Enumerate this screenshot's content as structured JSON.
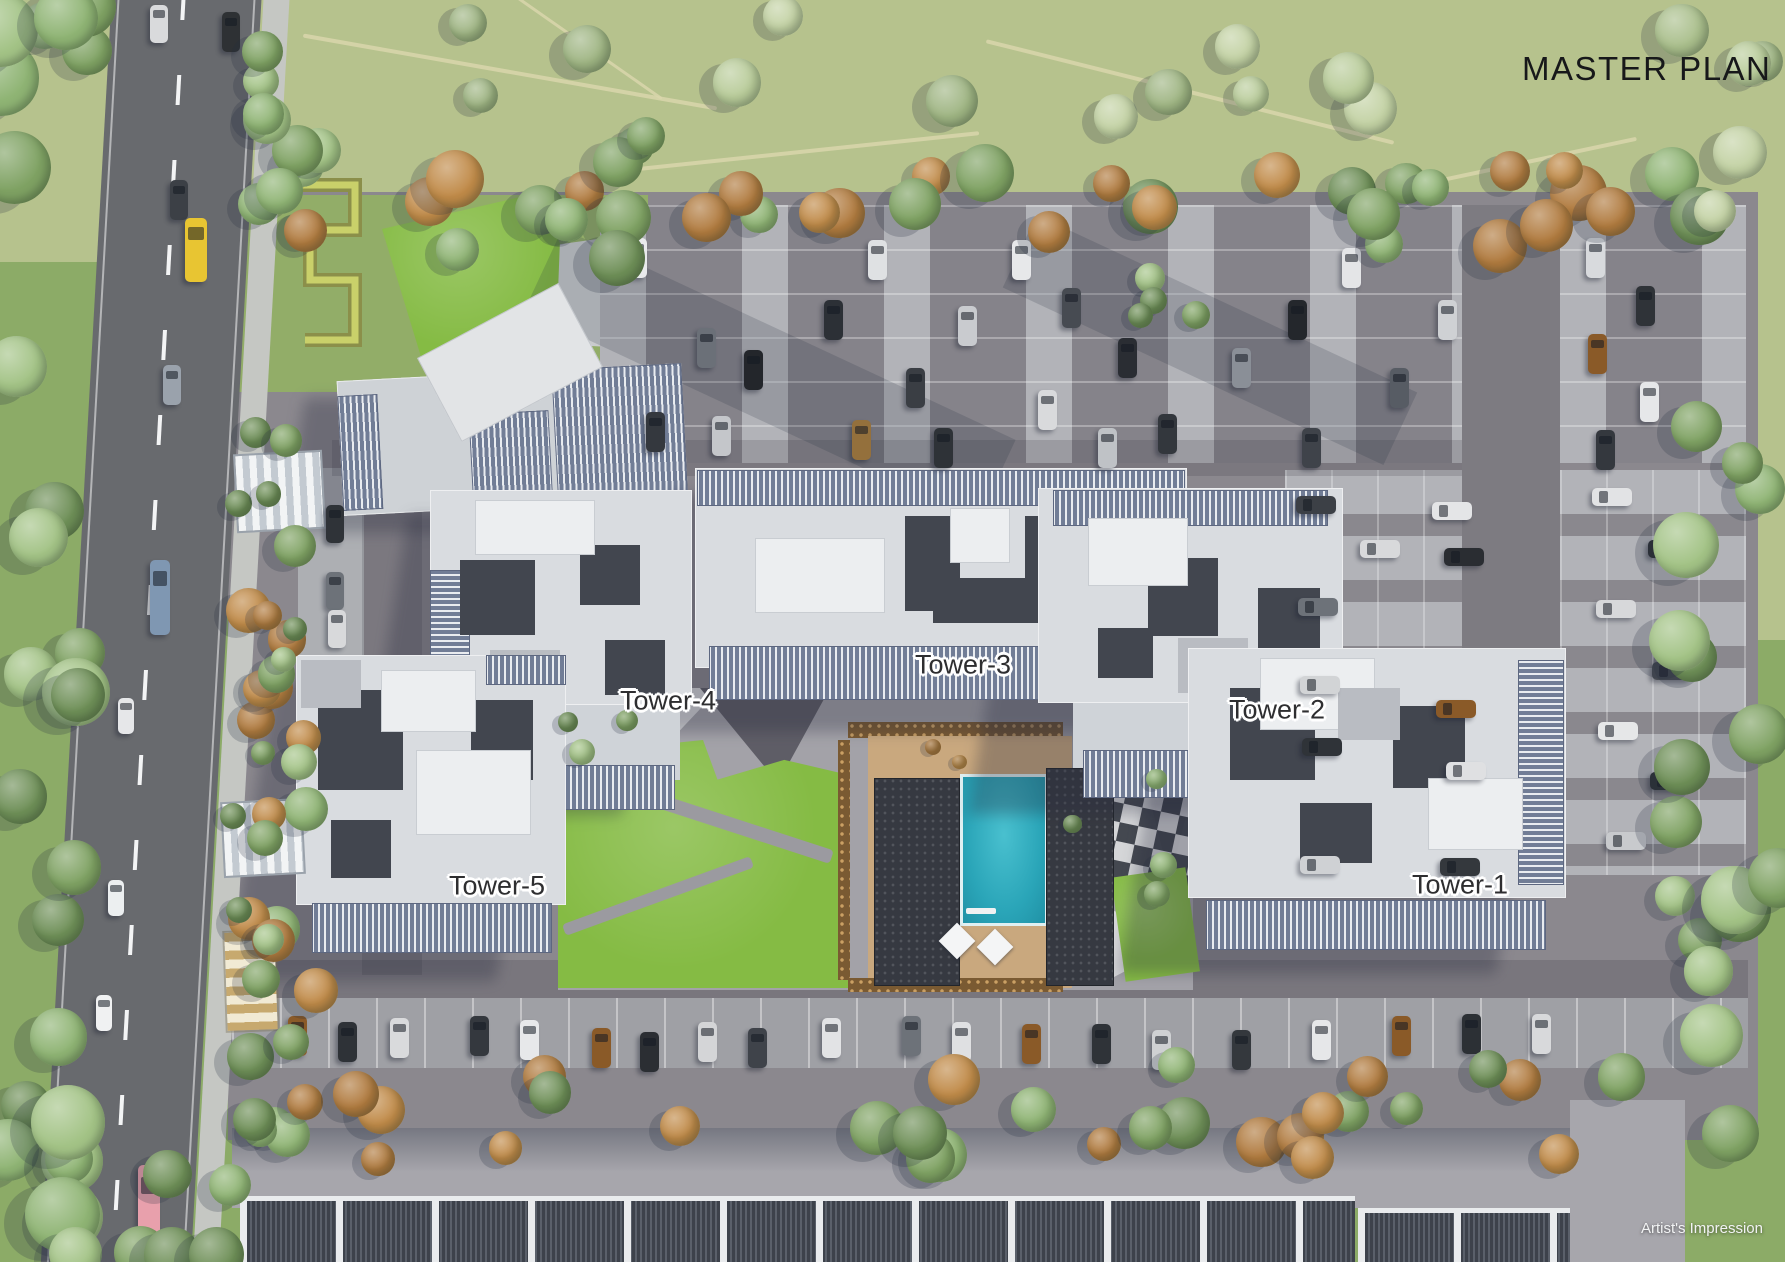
{
  "header": {
    "title": "MASTER PLAN"
  },
  "towers": [
    {
      "label": "Tower-1"
    },
    {
      "label": "Tower-2"
    },
    {
      "label": "Tower-3"
    },
    {
      "label": "Tower-4"
    },
    {
      "label": "Tower-5"
    }
  ],
  "footer": {
    "credit": "Artist's Impression"
  },
  "colors": {
    "pool": "#2aa5b8",
    "lawn": "#85bb44",
    "field": "#b6c28d",
    "road": "#686a6e",
    "tower_roof": "#d9dce0",
    "louver": "#717d96",
    "pool_deck": "#c9a87e",
    "title_text": "#17181a",
    "label_text": "#2e2e30"
  }
}
